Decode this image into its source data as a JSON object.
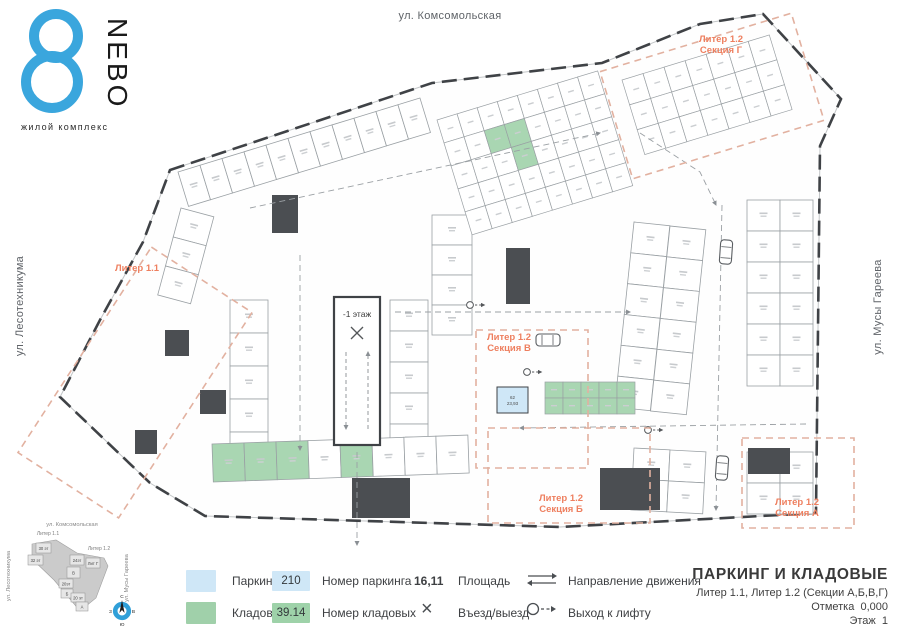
{
  "logo": {
    "brand": "NEBO",
    "tagline": "жилой комплекс",
    "accent": "#3aa6dd"
  },
  "streets": {
    "top": "ул. Комсомольская",
    "left": "ул. Лесотехникума",
    "right": "ул. Мусы Гареева"
  },
  "title_block": {
    "title": "ПАРКИНГ И КЛАДОВЫЕ",
    "subtitle": "Литер 1.1, Литер 1.2 (Секции А,Б,В,Г)",
    "mark": "Отметка  0,000",
    "floor": "Этаж  1"
  },
  "legend": {
    "parking_label": "Паркинг",
    "storage_label": "Кладовые",
    "parking_number": "210",
    "parking_number_label": "Номер паркинга",
    "storage_number": "39.14",
    "storage_number_label": "Номер кладовых",
    "area_value": "16,11",
    "area_label": "Площадь",
    "entry_icon": "×",
    "entry_label": "Въезд/выезд",
    "direction_label": "Направление движения",
    "lift_label": "Выход к лифту",
    "parking_color": "#cfe7f7",
    "storage_color": "#a0d0aa"
  },
  "plan": {
    "accent_orange": "#ee7f5f",
    "dash_orange": "#e2b1a0",
    "wall_dark": "#3f4246",
    "outline": "170,170 432,83 602,63 700,24 763,14 841,99 820,146 816,513 560,527 205,516 150,483 60,397 100,320 143,242",
    "sections": [
      {
        "x": 75,
        "y": 260,
        "w": 120,
        "h": 245,
        "angle": 33,
        "lines": [
          "Литер 1.1"
        ],
        "lx": 137,
        "ly": 271
      },
      {
        "x": 612,
        "y": 40,
        "w": 200,
        "h": 112,
        "angle": -17,
        "lines": [
          "Литер 1.2",
          "Секция Г"
        ],
        "lx": 721,
        "ly": 42
      },
      {
        "x": 476,
        "y": 330,
        "w": 112,
        "h": 138,
        "angle": 0,
        "lines": [
          "Литер 1.2",
          "Секция В"
        ],
        "lx": 509,
        "ly": 340
      },
      {
        "x": 488,
        "y": 428,
        "w": 162,
        "h": 95,
        "angle": 0,
        "lines": [
          "Литер 1.2",
          "Секция Б"
        ],
        "lx": 561,
        "ly": 501
      },
      {
        "x": 742,
        "y": 438,
        "w": 112,
        "h": 90,
        "angle": 0,
        "lines": [
          "Литер 1.2",
          "Секция А"
        ],
        "lx": 797,
        "ly": 505
      }
    ],
    "stallRows": [
      {
        "x": 178,
        "y": 172,
        "angle": -17,
        "n": 11,
        "sw": 23,
        "sh": 36,
        "dir": "h"
      },
      {
        "x": 181,
        "y": 208,
        "angle": 15,
        "n": 3,
        "sw": 34,
        "sh": 30,
        "dir": "v"
      },
      {
        "x": 230,
        "y": 300,
        "angle": 0,
        "n": 5,
        "sw": 38,
        "sh": 33,
        "dir": "v"
      },
      {
        "x": 390,
        "y": 300,
        "angle": 0,
        "n": 5,
        "sw": 38,
        "sh": 31,
        "dir": "v"
      },
      {
        "x": 432,
        "y": 215,
        "angle": 0,
        "n": 4,
        "sw": 40,
        "sh": 30,
        "dir": "v"
      },
      {
        "x": 634,
        "y": 222,
        "angle": 6,
        "n": 6,
        "sw": 36,
        "sh": 31,
        "dir": "v"
      },
      {
        "x": 670,
        "y": 226,
        "angle": 6,
        "n": 6,
        "sw": 36,
        "sh": 31,
        "dir": "v"
      },
      {
        "x": 634,
        "y": 448,
        "angle": 3,
        "n": 2,
        "sw": 36,
        "sh": 31,
        "dir": "v"
      },
      {
        "x": 670,
        "y": 450,
        "angle": 3,
        "n": 2,
        "sw": 36,
        "sh": 31,
        "dir": "v"
      },
      {
        "x": 747,
        "y": 200,
        "angle": 0,
        "n": 6,
        "sw": 33,
        "sh": 31,
        "dir": "v"
      },
      {
        "x": 780,
        "y": 200,
        "angle": 0,
        "n": 6,
        "sw": 33,
        "sh": 31,
        "dir": "v"
      },
      {
        "x": 747,
        "y": 452,
        "angle": 0,
        "n": 2,
        "sw": 33,
        "sh": 31,
        "dir": "v"
      },
      {
        "x": 780,
        "y": 452,
        "angle": 0,
        "n": 2,
        "sw": 33,
        "sh": 31,
        "dir": "v"
      },
      {
        "x": 212,
        "y": 444,
        "angle": -2,
        "n": 8,
        "sw": 32,
        "sh": 38,
        "dir": "h",
        "fills": [
          "g",
          "g",
          "g",
          "w",
          "g",
          "w",
          "w",
          "w"
        ]
      }
    ],
    "grids": [
      {
        "x": 437,
        "y": 120,
        "angle": -17,
        "rows": 5,
        "cols": 8,
        "cw": 21,
        "ch": 24,
        "greens": [
          10,
          11,
          19
        ]
      },
      {
        "x": 622,
        "y": 80,
        "angle": -17,
        "rows": 3,
        "cols": 7,
        "cw": 22,
        "ch": 26,
        "greens": []
      },
      {
        "x": 545,
        "y": 382,
        "angle": 0,
        "rows": 2,
        "cols": 5,
        "cw": 18,
        "ch": 16,
        "greens": [
          0,
          1,
          2,
          3,
          4,
          5,
          6,
          7,
          8,
          9
        ]
      }
    ],
    "darkRooms": [
      [
        272,
        195,
        26,
        38
      ],
      [
        506,
        248,
        24,
        56
      ],
      [
        352,
        478,
        58,
        40
      ],
      [
        600,
        468,
        60,
        42
      ],
      [
        748,
        448,
        42,
        26
      ],
      [
        165,
        330,
        24,
        26
      ],
      [
        200,
        390,
        26,
        24
      ],
      [
        135,
        430,
        22,
        24
      ]
    ],
    "lanes": [
      {
        "pts": [
          [
            250,
            208
          ],
          [
            600,
            133
          ]
        ]
      },
      {
        "pts": [
          [
            300,
            255
          ],
          [
            300,
            450
          ]
        ]
      },
      {
        "pts": [
          [
            395,
            312
          ],
          [
            630,
            312
          ]
        ]
      },
      {
        "pts": [
          [
            640,
            133
          ],
          [
            700,
            172
          ],
          [
            716,
            205
          ]
        ]
      },
      {
        "pts": [
          [
            722,
            205
          ],
          [
            716,
            510
          ]
        ]
      },
      {
        "pts": [
          [
            806,
            424
          ],
          [
            520,
            428
          ]
        ]
      },
      {
        "pts": [
          [
            357,
            452
          ],
          [
            357,
            545
          ]
        ]
      }
    ],
    "cars": [
      [
        548,
        340,
        90
      ],
      [
        726,
        252,
        4
      ],
      [
        722,
        468,
        4
      ]
    ],
    "lifts": [
      [
        470,
        305
      ],
      [
        527,
        372
      ],
      [
        648,
        430
      ]
    ],
    "ramp": {
      "x": 334,
      "y": 297,
      "w": 46,
      "h": 148,
      "label": "-1 этаж"
    },
    "highlight": {
      "x": 497,
      "y": 387,
      "w": 31,
      "h": 26,
      "num": "62",
      "area": "23,93"
    }
  },
  "minimap": {
    "streets": {
      "top": "ул. Комсомольская",
      "left": "ул. Лесотехникума",
      "right": "ул. Мусы Гареева"
    },
    "liters": [
      {
        "label": "Литер 1.1",
        "x": 48,
        "y": 21
      },
      {
        "label": "Литер 1.2",
        "x": 99,
        "y": 36
      }
    ],
    "outline": "32,30 56,26 77,39 104,44 108,52 96,84 80,97 54,66 32,45",
    "boxes": [
      {
        "x": 36,
        "y": 29,
        "w": 15,
        "h": 10,
        "label": "30 эт"
      },
      {
        "x": 28,
        "y": 41,
        "w": 15,
        "h": 10,
        "label": "32 эт"
      },
      {
        "x": 70,
        "y": 41,
        "w": 14,
        "h": 10,
        "label": "24эт"
      },
      {
        "x": 86,
        "y": 44,
        "w": 14,
        "h": 10,
        "label": "Лит Г"
      },
      {
        "x": 67,
        "y": 53,
        "w": 13,
        "h": 11,
        "label": "В"
      },
      {
        "x": 59,
        "y": 65,
        "w": 14,
        "h": 9,
        "label": "20эт"
      },
      {
        "x": 61,
        "y": 75,
        "w": 12,
        "h": 9,
        "label": "Б"
      },
      {
        "x": 71,
        "y": 79,
        "w": 14,
        "h": 9,
        "label": "20 эт"
      },
      {
        "x": 76,
        "y": 88,
        "w": 12,
        "h": 9,
        "label": "А"
      }
    ],
    "compass": {
      "x": 122,
      "y": 97,
      "n": "С",
      "e": "В",
      "s": "Ю",
      "w": "З"
    }
  }
}
